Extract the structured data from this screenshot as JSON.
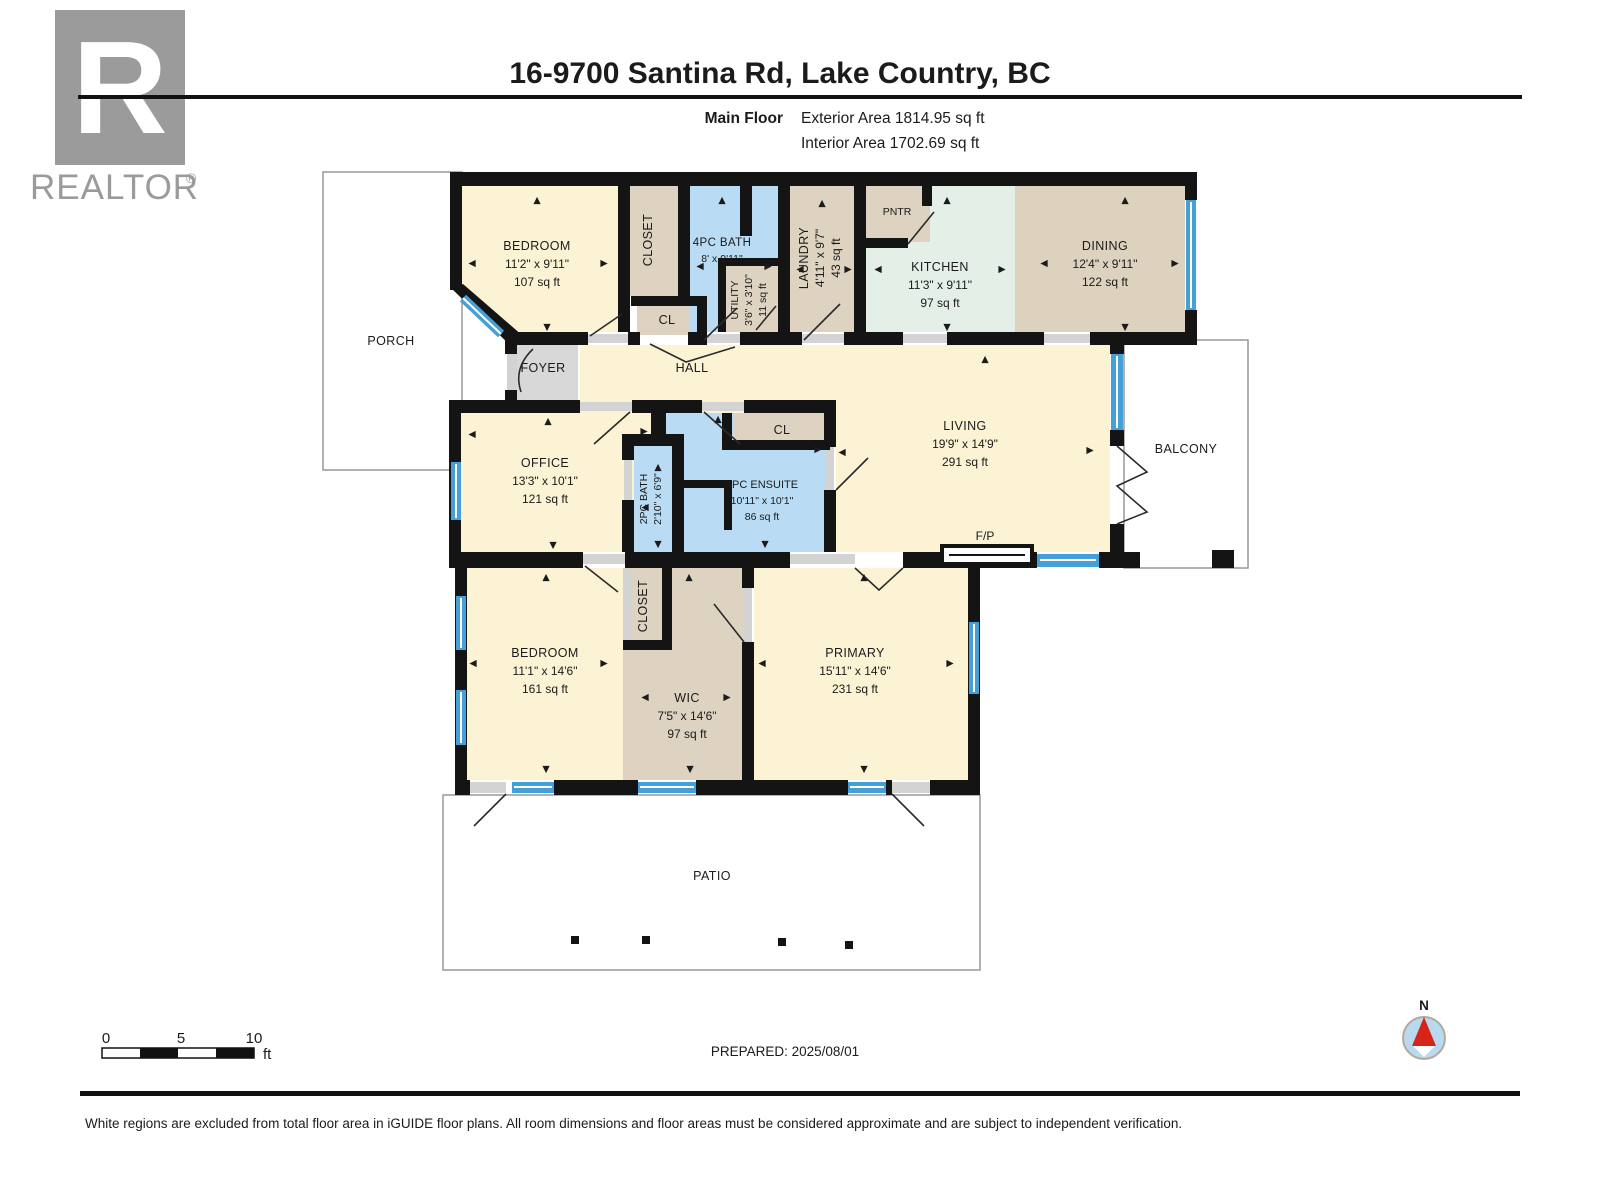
{
  "header": {
    "title": "16-9700 Santina Rd, Lake Country, BC",
    "floor_label": "Main Floor",
    "exterior_area": "Exterior Area 1814.95 sq ft",
    "interior_area": "Interior Area 1702.69 sq ft"
  },
  "logo": {
    "letter": "R",
    "brand": "REALTOR",
    "registered": "®"
  },
  "rooms": {
    "bedroom_top": {
      "name": "BEDROOM",
      "dims": "11'2\" x 9'11\"",
      "area": "107 sq ft"
    },
    "closet_top": {
      "name": "CLOSET"
    },
    "cl_top": {
      "name": "CL"
    },
    "bath_4pc": {
      "name": "4PC BATH",
      "dims": "8' x 9'11\""
    },
    "utility": {
      "name": "UTILITY",
      "dims": "3'6\" x 3'10\"",
      "area": "11 sq ft"
    },
    "laundry": {
      "name": "LAUNDRY",
      "dims": "4'11\" x 9'7\"",
      "area": "43 sq ft"
    },
    "pantry": {
      "name": "PNTR"
    },
    "kitchen": {
      "name": "KITCHEN",
      "dims": "11'3\" x 9'11\"",
      "area": "97 sq ft"
    },
    "dining": {
      "name": "DINING",
      "dims": "12'4\" x 9'11\"",
      "area": "122 sq ft"
    },
    "porch": {
      "name": "PORCH"
    },
    "foyer": {
      "name": "FOYER"
    },
    "hall": {
      "name": "HALL"
    },
    "office": {
      "name": "OFFICE",
      "dims": "13'3\" x 10'1\"",
      "area": "121 sq ft"
    },
    "bath_2pc": {
      "name": "2PC BATH",
      "dims": "2'10\" x 6'9\""
    },
    "ensuite": {
      "name": "4PC ENSUITE",
      "dims": "10'11\" x 10'1\"",
      "area": "86 sq ft"
    },
    "cl_ensuite": {
      "name": "CL"
    },
    "living": {
      "name": "LIVING",
      "dims": "19'9\" x 14'9\"",
      "area": "291 sq ft"
    },
    "fireplace": {
      "name": "F/P"
    },
    "balcony": {
      "name": "BALCONY"
    },
    "bedroom_bottom": {
      "name": "BEDROOM",
      "dims": "11'1\" x 14'6\"",
      "area": "161 sq ft"
    },
    "closet_bottom": {
      "name": "CLOSET"
    },
    "wic": {
      "name": "WIC",
      "dims": "7'5\" x 14'6\"",
      "area": "97 sq ft"
    },
    "primary": {
      "name": "PRIMARY",
      "dims": "15'11\" x 14'6\"",
      "area": "231 sq ft"
    },
    "patio": {
      "name": "PATIO"
    }
  },
  "icons": {
    "up": "▲",
    "down": "▼",
    "left": "◀",
    "right": "▶"
  },
  "footer": {
    "scale_0": "0",
    "scale_5": "5",
    "scale_10": "10",
    "scale_unit": "ft",
    "prepared": "PREPARED: 2025/08/01",
    "compass_label": "N",
    "disclaimer": "White regions are excluded from total floor area in iGUIDE floor plans. All room dimensions and floor areas must be considered approximate and are subject to independent verification."
  },
  "colors": {
    "wall": "#141414",
    "floor_cream": "#fcf2d4",
    "floor_beige": "#ddd3c0",
    "floor_blue": "#b9dbf3",
    "floor_mint": "#e4efe7",
    "floor_tan": "#ddd2bd",
    "floor_gray": "#d8d8d8",
    "window_blue": "#459fd8",
    "logo_gray": "#9b9b9b",
    "compass_fill": "#b9d9ee",
    "north_red": "#d62518"
  }
}
